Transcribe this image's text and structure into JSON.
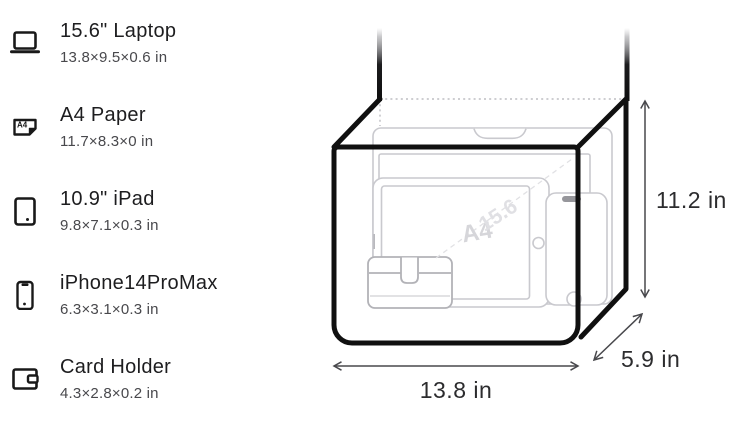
{
  "items": [
    {
      "name": "15.6\" Laptop",
      "dims": "13.8×9.5×0.6 in"
    },
    {
      "name": "A4 Paper",
      "dims": "11.7×8.3×0 in"
    },
    {
      "name": "10.9\" iPad",
      "dims": "9.8×7.1×0.3 in"
    },
    {
      "name": "iPhone14ProMax",
      "dims": "6.3×3.1×0.3 in"
    },
    {
      "name": "Card Holder",
      "dims": "4.3×2.8×0.2 in"
    }
  ],
  "icons": {
    "a4_label": "A4"
  },
  "diagram": {
    "height_label": "11.2 in",
    "width_label": "13.8 in",
    "depth_label": "5.9 in",
    "a4_watermark": "A4",
    "laptop_watermark": "15.6",
    "outline_color": "#101010",
    "content_outline_color": "#c9c9ce",
    "dimension_color": "#48484c"
  }
}
